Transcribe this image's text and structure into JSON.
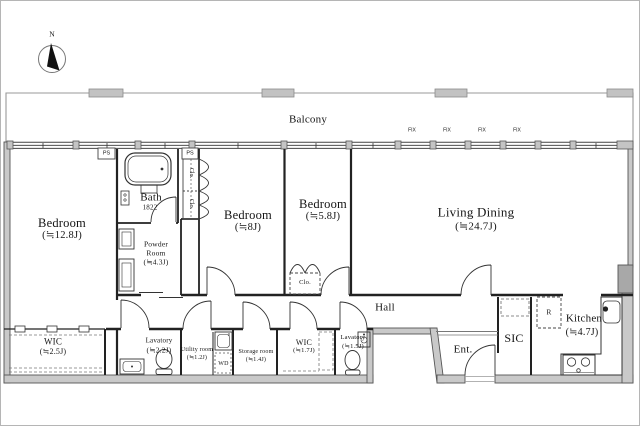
{
  "compass": {
    "north": "N"
  },
  "balcony": {
    "label": "Balcony"
  },
  "rooms": {
    "bedroom_west": {
      "name": "Bedroom",
      "size": "(≒12.8J)"
    },
    "bath": {
      "name": "Bath",
      "size": "1822"
    },
    "powder_room": {
      "line1": "Powder",
      "line2": "Room",
      "size": "(≒4.3J)"
    },
    "bedroom_center": {
      "name": "Bedroom",
      "size": "(≒8J)"
    },
    "bedroom_east": {
      "name": "Bedroom",
      "size": "(≒5.8J)"
    },
    "living_dining": {
      "name": "Living Dining",
      "size": "(≒24.7J)"
    },
    "hall": {
      "name": "Hall"
    },
    "wic_west": {
      "name": "WIC",
      "size": "(≒2.5J)"
    },
    "lavatory_west": {
      "name": "Lavatory",
      "size": "(≒2.2J)"
    },
    "utility_room": {
      "name": "Utility room",
      "size": "(≒1.2J)"
    },
    "storage_room": {
      "name": "Storage room",
      "size": "(≒1.4J)"
    },
    "wic_east": {
      "name": "WIC",
      "size": "(≒1.7J)"
    },
    "lavatory_east": {
      "name": "Lavatory",
      "size": "(≒1.5J)"
    },
    "entrance": {
      "name": "Ent."
    },
    "sic": {
      "name": "SIC"
    },
    "kitchen": {
      "name": "Kitchen",
      "size": "(≒4.7J)"
    }
  },
  "fixtures": {
    "washer_dryer": "WD",
    "refrigerator": "R"
  },
  "annotations": {
    "pipe_space": "PS",
    "closet": "Clo.",
    "fixed_window": "FIX"
  },
  "colors": {
    "wall_fill": "#c9c9c9",
    "line": "#1a1a1a",
    "balcony_line": "#999999"
  }
}
